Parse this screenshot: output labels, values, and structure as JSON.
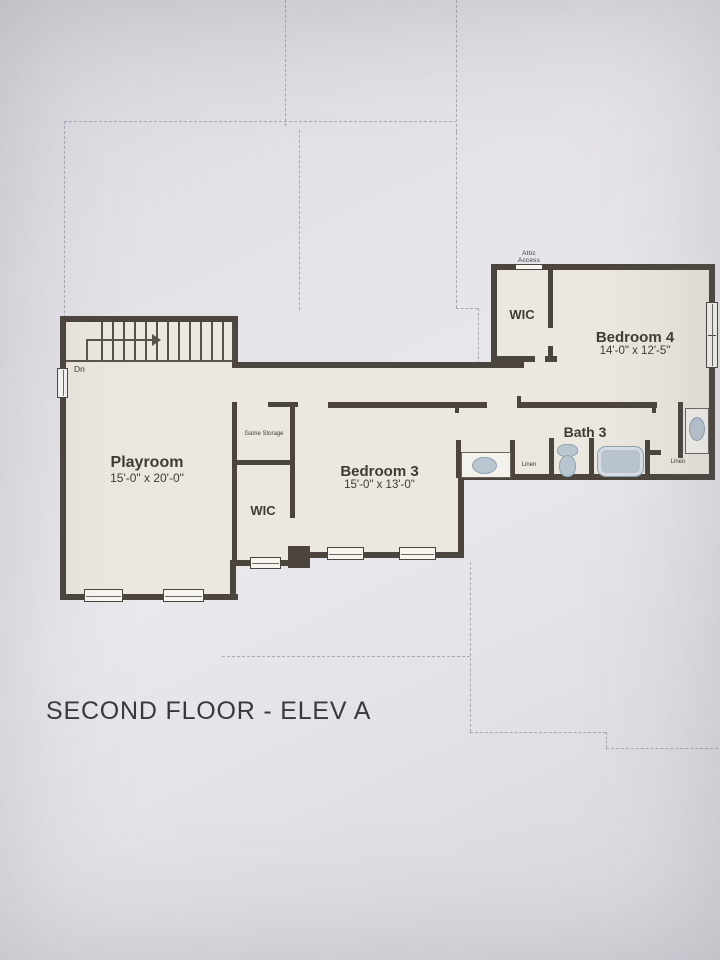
{
  "title": "SECOND FLOOR - ELEV A",
  "rooms": [
    {
      "name": "Playroom",
      "dims": "15'-0\" x 20'-0\""
    },
    {
      "name": "Bedroom 3",
      "dims": "15'-0\" x 13'-0\""
    },
    {
      "name": "Bedroom 4",
      "dims": "14'-0\" x 12'-5\""
    },
    {
      "name": "Bath 3"
    },
    {
      "name": "WIC"
    },
    {
      "name": "WIC"
    },
    {
      "name": "Game Storage"
    }
  ],
  "labels": {
    "attic_line1": "Attic",
    "attic_line2": "Access",
    "linen": "Linen",
    "stairs_down": "Dn"
  },
  "colors": {
    "paper": "#e2e1e6",
    "floor": "#ebe8df",
    "wall": "#4b453e",
    "fixture": "#b9c6d2",
    "dashed_line": "#a9a7b1"
  }
}
